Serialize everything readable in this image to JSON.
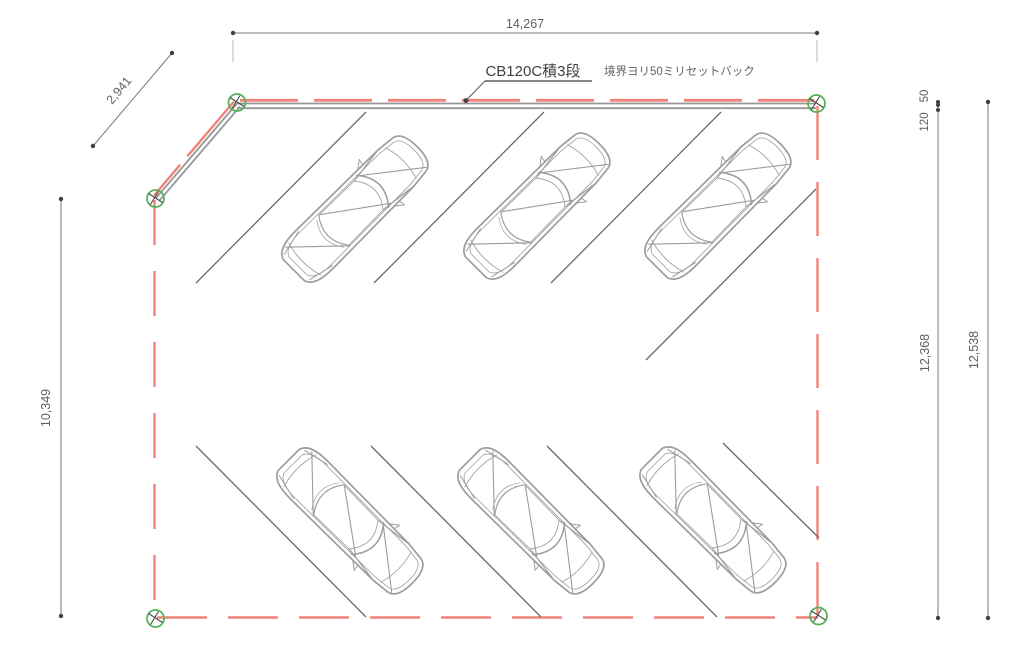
{
  "drawing": {
    "notes": {
      "block_note": "CB120C積3段",
      "setback_note": "境界ヨリ50ミリセットバック"
    },
    "dimensions": {
      "top_width": "14,267",
      "northwest_diagonal": "2,941",
      "left_height": "10,349",
      "right_setback": "50",
      "right_block": "120",
      "right_inner_height": "12,368",
      "right_total_height": "12,538"
    },
    "colors": {
      "boundary_red": "#f2837a",
      "marker_green": "#55b35b",
      "wall_gray": "#979797",
      "car_gray": "#9d9d9d",
      "stall_gray": "#6a6a6a",
      "dimension_gray": "#7a7a7a",
      "text_dark": "#404040"
    }
  }
}
